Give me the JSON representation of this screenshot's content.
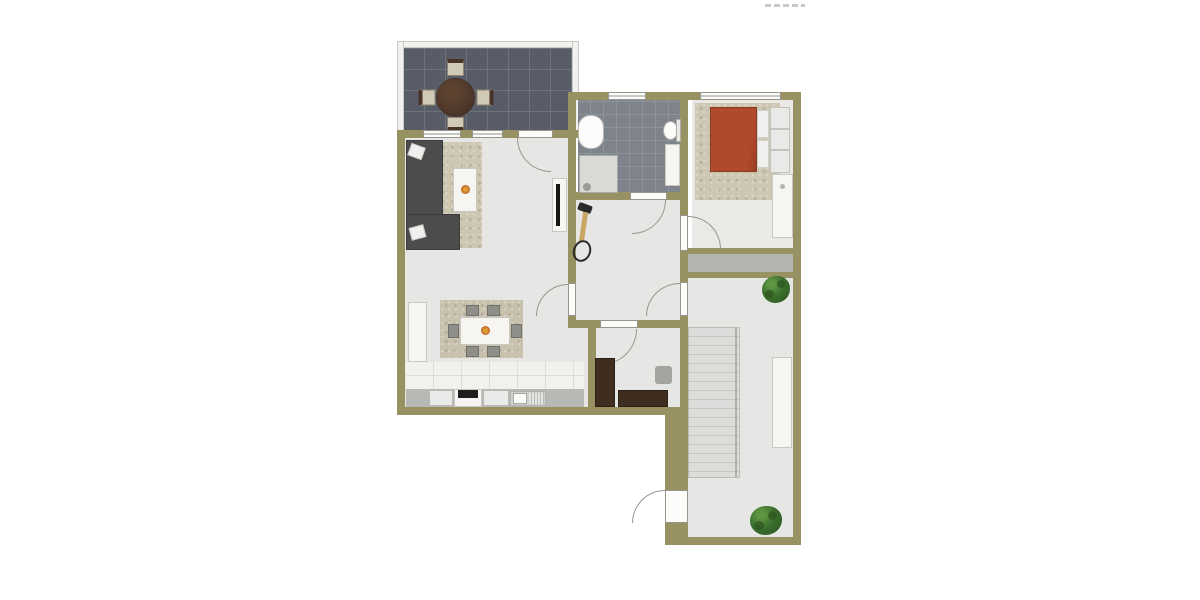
{
  "canvas": {
    "width": 1200,
    "height": 600,
    "background": "#ffffff"
  },
  "watermark": {
    "legible": false,
    "color": "#9a9a9a"
  },
  "palette": {
    "white": "#ffffff",
    "wall": "#989162",
    "floor": "#e6e6e4",
    "floor_bed": "#ebe9e5",
    "terrace_tile": "#575c66",
    "terrace_grout": "#6d727c",
    "bath_tile": "#7f838c",
    "bath_grout": "#8e929b",
    "railing": "#f1f1ef",
    "railing_border": "#c8c8c4",
    "rug": "#cdc6b2",
    "rug_dining": "#c8c1ad",
    "sofa": "#4c4c4c",
    "pillow": "#f0f0ee",
    "table_white": "#f6f5f2",
    "furn_border": "#c9c7c1",
    "wood_dark": "#4a3428",
    "wood_study": "#3f2e1f",
    "bed": "#b04a2d",
    "plant": "#3a6e2c",
    "plant_dark": "#2c5420",
    "counter": "#b8b8b4",
    "counter_front": "#eaeae8",
    "hob": "#1e1e1e",
    "stairs": "#dcdcda",
    "stair_line": "#c4c4c1",
    "storage": "#b4b4b0",
    "door_line": "#96968f",
    "window_fill": "#fcfcfa",
    "tv": "#161616",
    "bike_frame": "#c9a663",
    "bike_dark": "#2a2a2a",
    "gray_item": "#a3a3a0",
    "tile_strip": "#f2f1ed",
    "tile_strip_line": "#dedcd6",
    "shower": "#d9d9d5",
    "chair": "#8f8f8a",
    "chair_dark": "#70706b",
    "terrace_chair": "#cfc9b6",
    "flower": "#e09a3a",
    "flower_dark": "#b55a1f",
    "watermark": "#9a9a9a"
  }
}
